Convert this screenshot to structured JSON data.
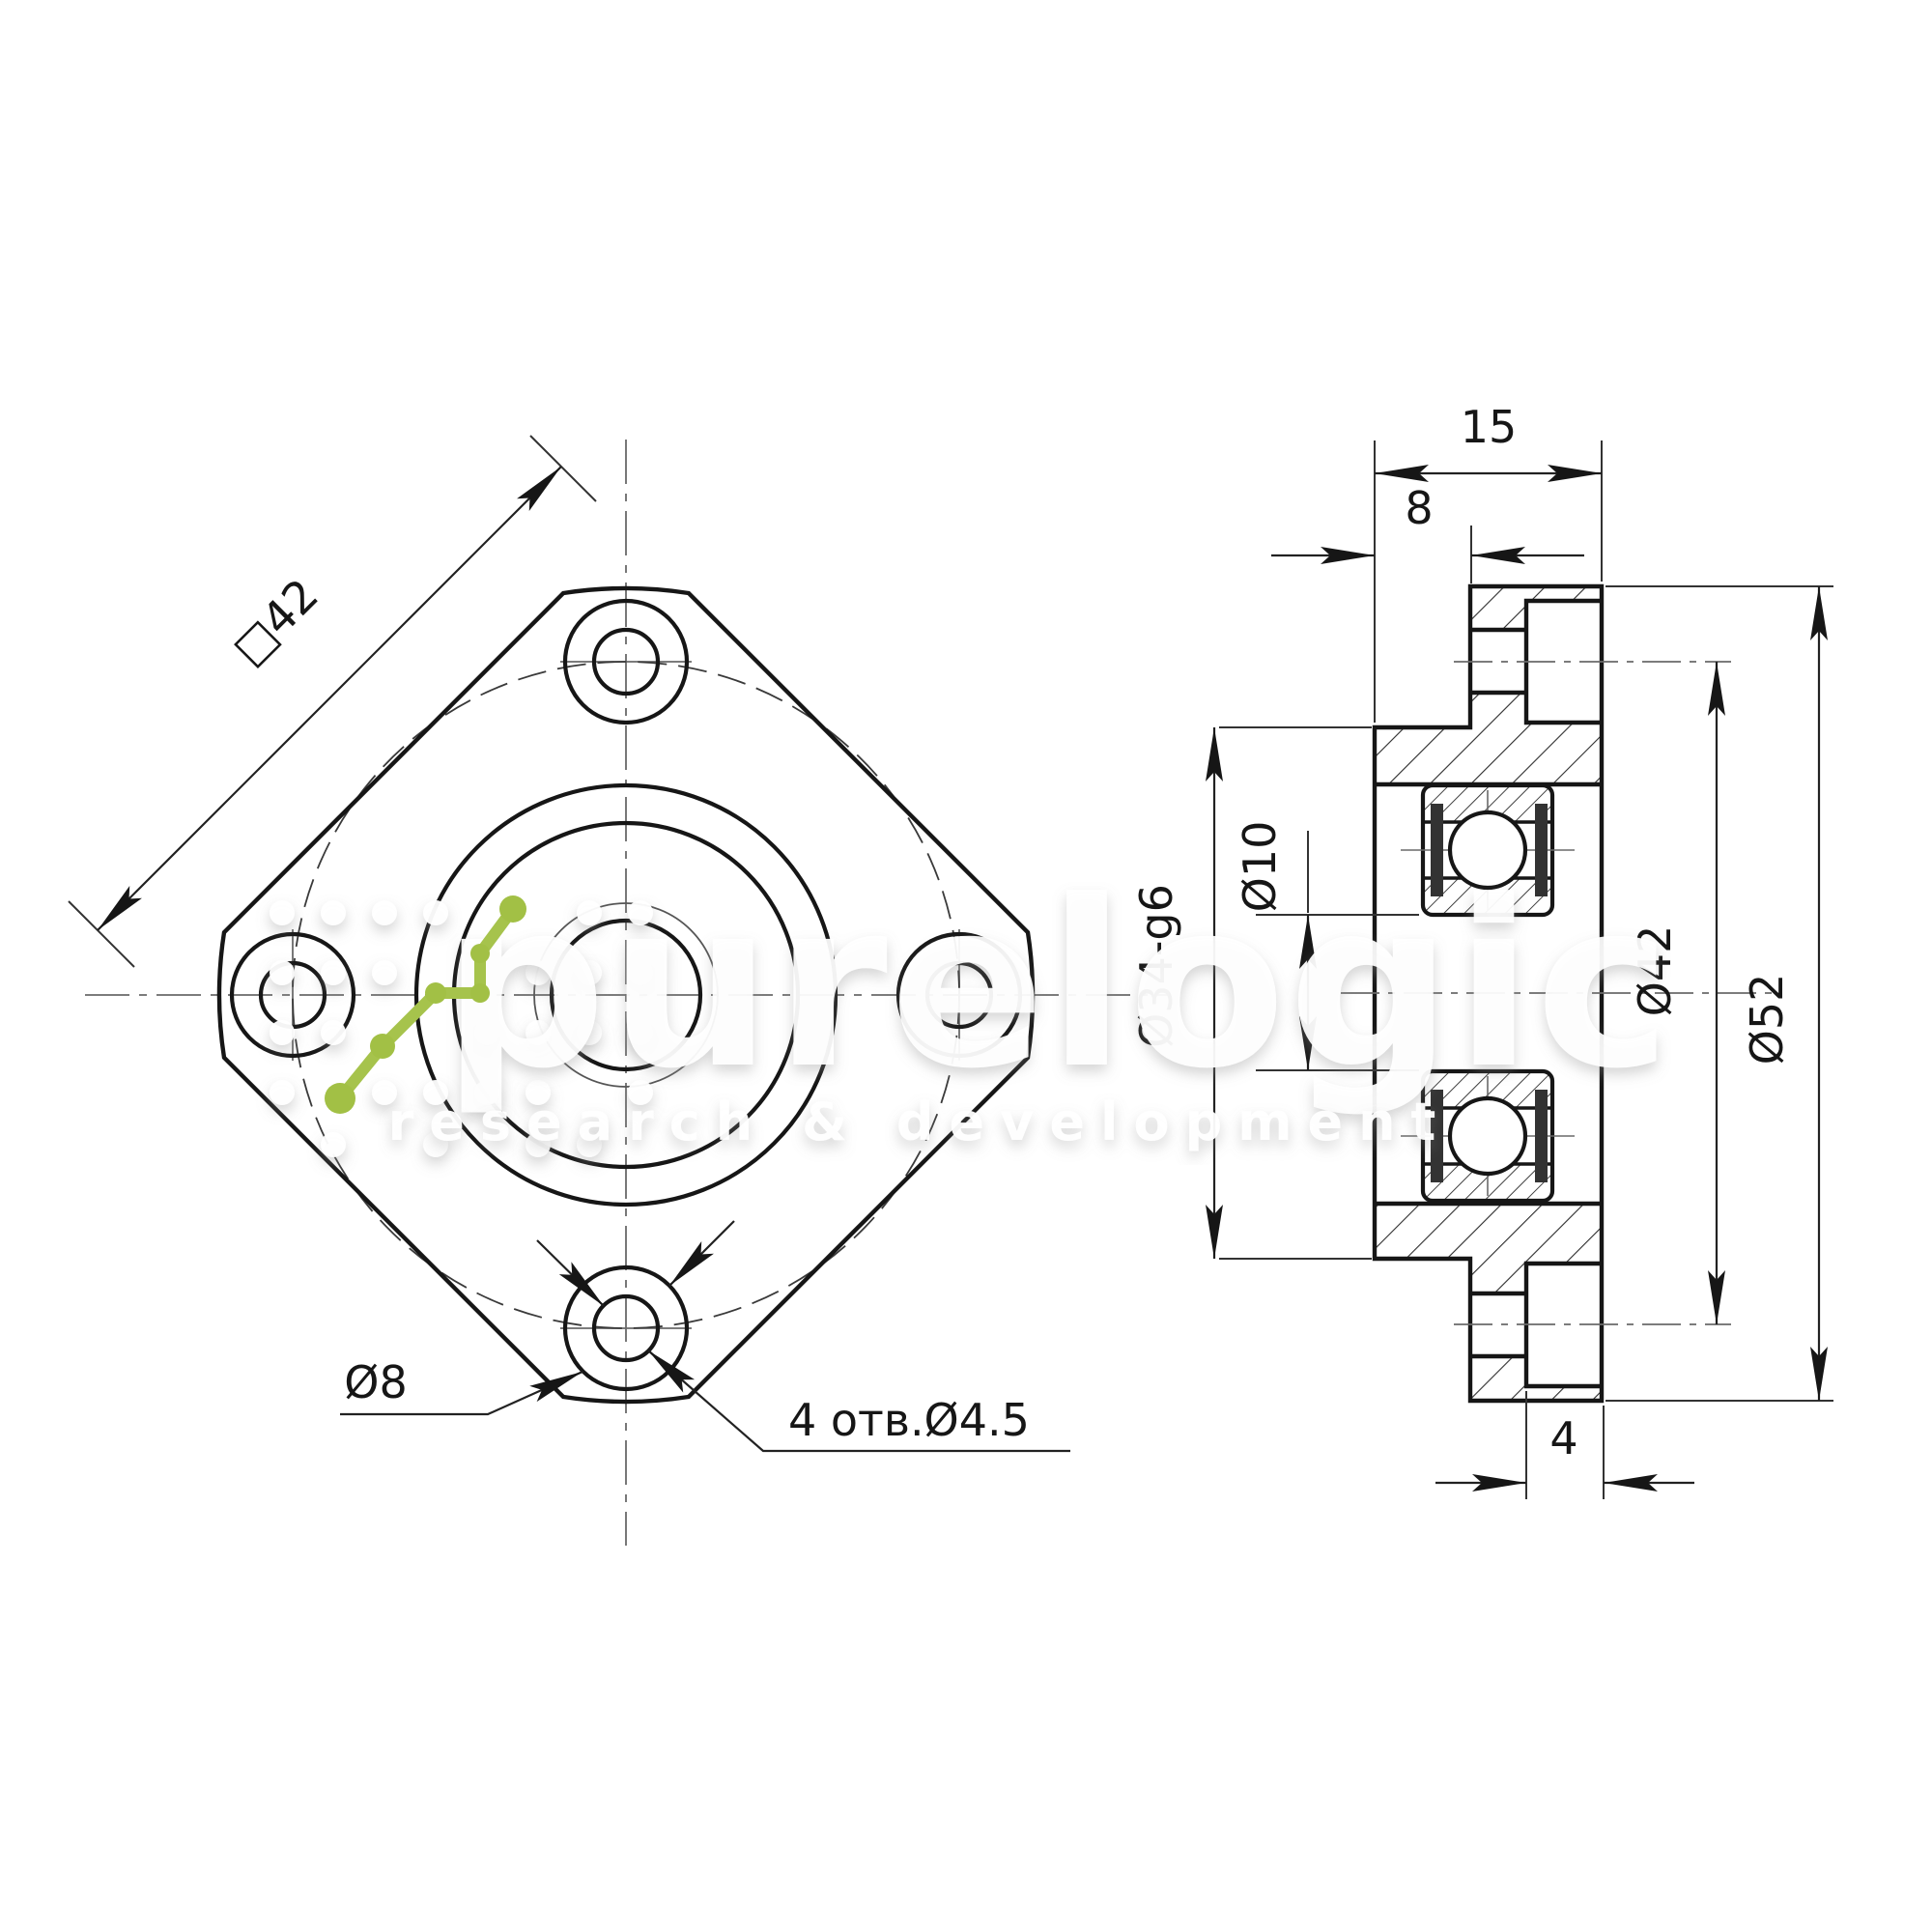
{
  "meta": {
    "type": "engineering-drawing",
    "part": "flanged bearing mount, two views (front view and axial section)"
  },
  "front": {
    "dim_square": "□42",
    "leader_counterbore": "Ø8",
    "leader_holes": "4 отв.Ø4.5"
  },
  "section": {
    "dim_width_total": "15",
    "dim_spigot_length": "8",
    "dim_bore": "Ø10",
    "dim_spigot_diameter": "Ø34-g6",
    "dim_bolt_circle": "Ø42",
    "dim_flange_od": "Ø52",
    "dim_recess_depth": "4"
  },
  "watermark": {
    "brand": "purelogic",
    "tagline": "research & development"
  },
  "colors": {
    "line": "#161616",
    "thin_line": "#333333",
    "centerline": "#6a6a6a",
    "accent_green": "#a6c34c",
    "background": "#ffffff"
  }
}
